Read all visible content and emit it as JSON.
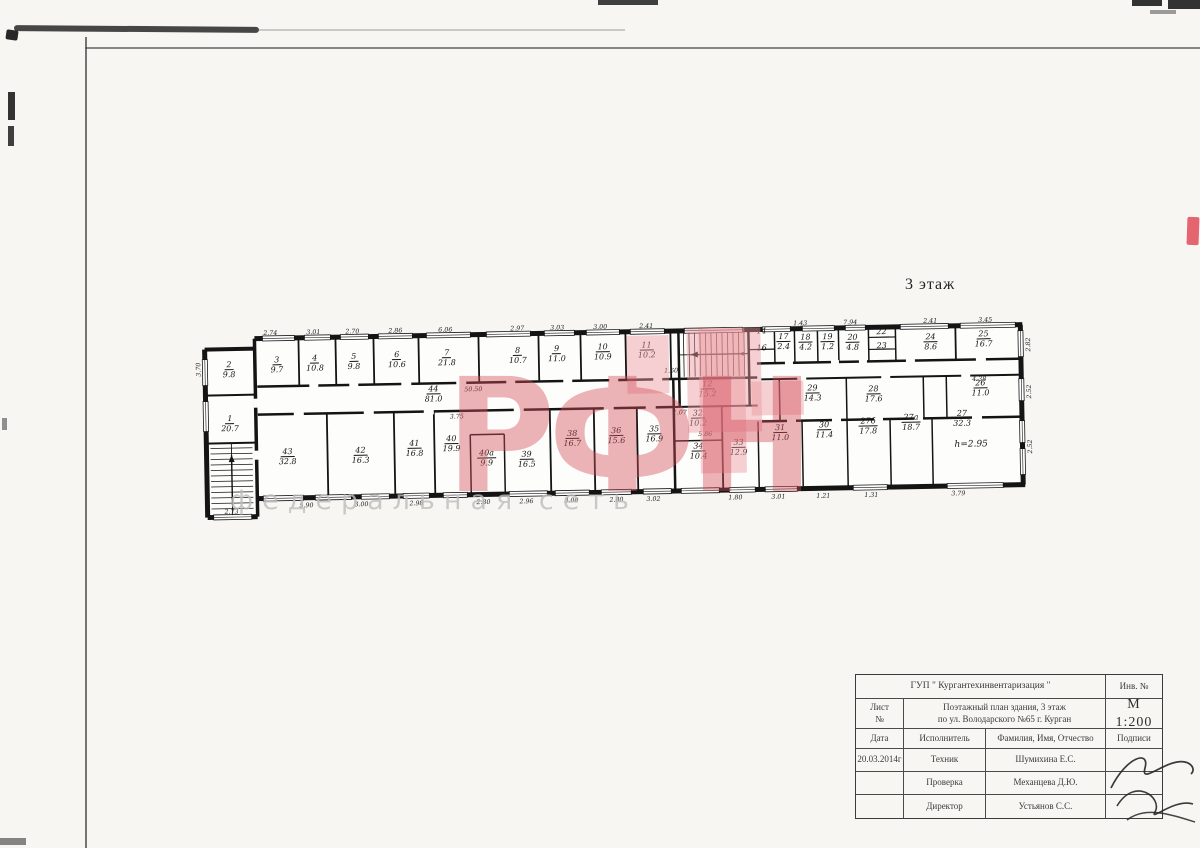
{
  "page": {
    "floor_label": "3 этаж",
    "watermark_big": "РФН",
    "watermark_sub": "федеральная сеть",
    "accent_pink": "#e0a6ab",
    "stamp_red": "#e04a58",
    "ink": "#141414"
  },
  "plan": {
    "h_label": "h=2.95",
    "rooms": [
      {
        "num": "1",
        "area": "20.7",
        "x": 28,
        "y": 92
      },
      {
        "num": "2",
        "area": "9.8",
        "x": 28,
        "y": 38
      },
      {
        "num": "3",
        "area": "9.7",
        "x": 76,
        "y": 34
      },
      {
        "num": "4",
        "area": "10.8",
        "x": 114,
        "y": 33
      },
      {
        "num": "5",
        "area": "9.8",
        "x": 153,
        "y": 32
      },
      {
        "num": "6",
        "area": "10.6",
        "x": 196,
        "y": 31
      },
      {
        "num": "7",
        "area": "21.8",
        "x": 246,
        "y": 30
      },
      {
        "num": "8",
        "area": "10.7",
        "x": 317,
        "y": 29
      },
      {
        "num": "9",
        "area": "11.0",
        "x": 356,
        "y": 28
      },
      {
        "num": "10",
        "area": "10.9",
        "x": 402,
        "y": 27
      },
      {
        "num": "11",
        "area": "10.2",
        "x": 446,
        "y": 26
      },
      {
        "num": "14",
        "area": "",
        "x": 561,
        "y": 14
      },
      {
        "num": "16",
        "area": "",
        "x": 561,
        "y": 31
      },
      {
        "num": "17",
        "area": "2.4",
        "x": 583,
        "y": 20
      },
      {
        "num": "18",
        "area": "4.2",
        "x": 605,
        "y": 21
      },
      {
        "num": "19",
        "area": "1.2",
        "x": 627,
        "y": 21
      },
      {
        "num": "20",
        "area": "4.8",
        "x": 652,
        "y": 22
      },
      {
        "num": "22",
        "area": "",
        "x": 681,
        "y": 17
      },
      {
        "num": "23",
        "area": "",
        "x": 681,
        "y": 31
      },
      {
        "num": "24",
        "area": "8.6",
        "x": 730,
        "y": 23
      },
      {
        "num": "25",
        "area": "16.7",
        "x": 783,
        "y": 21
      },
      {
        "num": "44",
        "area": "81.0",
        "x": 232,
        "y": 66
      },
      {
        "num": "12",
        "area": "15.2",
        "x": 506,
        "y": 66
      },
      {
        "num": "29",
        "area": "14.3",
        "x": 611,
        "y": 72
      },
      {
        "num": "28",
        "area": "17.6",
        "x": 672,
        "y": 74
      },
      {
        "num": "26",
        "area": "11.0",
        "x": 779,
        "y": 70
      },
      {
        "num": "32",
        "area": "10.2",
        "x": 496,
        "y": 95
      },
      {
        "num": "43",
        "area": "32.8",
        "x": 85,
        "y": 126
      },
      {
        "num": "42",
        "area": "16.3",
        "x": 158,
        "y": 126
      },
      {
        "num": "41",
        "area": "16.8",
        "x": 212,
        "y": 120
      },
      {
        "num": "40",
        "area": "19.9",
        "x": 249,
        "y": 116
      },
      {
        "num": "40а",
        "area": "9.9",
        "x": 284,
        "y": 131
      },
      {
        "num": "39",
        "area": "16.5",
        "x": 324,
        "y": 133
      },
      {
        "num": "38",
        "area": "16.7",
        "x": 370,
        "y": 113
      },
      {
        "num": "36",
        "area": "15.6",
        "x": 414,
        "y": 111
      },
      {
        "num": "35",
        "area": "16.9",
        "x": 452,
        "y": 110
      },
      {
        "num": "34",
        "area": "10.4",
        "x": 496,
        "y": 128
      },
      {
        "num": "33",
        "area": "12.9",
        "x": 536,
        "y": 125
      },
      {
        "num": "31",
        "area": "11.0",
        "x": 578,
        "y": 111
      },
      {
        "num": "30",
        "area": "11.4",
        "x": 622,
        "y": 109
      },
      {
        "num": "27б",
        "area": "17.8",
        "x": 666,
        "y": 106
      },
      {
        "num": "27а",
        "area": "18.7",
        "x": 709,
        "y": 103
      },
      {
        "num": "27",
        "area": "32.3",
        "x": 760,
        "y": 100
      }
    ],
    "dims": [
      {
        "t": "2.74",
        "x": 70,
        "y": 3
      },
      {
        "t": "3.01",
        "x": 113,
        "y": 3
      },
      {
        "t": "2.70",
        "x": 152,
        "y": 3
      },
      {
        "t": "2.86",
        "x": 195,
        "y": 3
      },
      {
        "t": "6.06",
        "x": 245,
        "y": 3
      },
      {
        "t": "2.97",
        "x": 317,
        "y": 3
      },
      {
        "t": "3.03",
        "x": 357,
        "y": 3
      },
      {
        "t": "3.00",
        "x": 400,
        "y": 3
      },
      {
        "t": "2.41",
        "x": 446,
        "y": 3
      },
      {
        "t": "1.43",
        "x": 600,
        "y": 3
      },
      {
        "t": "7.94",
        "x": 650,
        "y": 3
      },
      {
        "t": "2.41",
        "x": 730,
        "y": 3
      },
      {
        "t": "3.45",
        "x": 785,
        "y": 3
      },
      {
        "t": "2.73",
        "x": 28,
        "y": 181
      },
      {
        "t": "5.90",
        "x": 103,
        "y": 176
      },
      {
        "t": "3.00",
        "x": 158,
        "y": 176
      },
      {
        "t": "2.98",
        "x": 213,
        "y": 176
      },
      {
        "t": "2.80",
        "x": 280,
        "y": 176
      },
      {
        "t": "2.96",
        "x": 323,
        "y": 176
      },
      {
        "t": "3.00",
        "x": 368,
        "y": 176
      },
      {
        "t": "2.80",
        "x": 413,
        "y": 176
      },
      {
        "t": "3.02",
        "x": 450,
        "y": 176
      },
      {
        "t": "1.80",
        "x": 532,
        "y": 176
      },
      {
        "t": "3.01",
        "x": 575,
        "y": 176
      },
      {
        "t": "1.21",
        "x": 620,
        "y": 176
      },
      {
        "t": "1.31",
        "x": 668,
        "y": 176
      },
      {
        "t": "3.79",
        "x": 755,
        "y": 176
      },
      {
        "t": "3.70",
        "x": -2,
        "y": 38,
        "r": 1
      },
      {
        "t": "2.82",
        "x": 828,
        "y": 28,
        "r": 1
      },
      {
        "t": "2.52",
        "x": 828,
        "y": 75,
        "r": 1
      },
      {
        "t": "2.52",
        "x": 828,
        "y": 130,
        "r": 1
      },
      {
        "t": "50.50",
        "x": 272,
        "y": 63
      },
      {
        "t": "3.75",
        "x": 255,
        "y": 90
      },
      {
        "t": "5.86",
        "x": 503,
        "y": 112
      },
      {
        "t": "4.38",
        "x": 778,
        "y": 62
      },
      {
        "t": "1.07",
        "x": 478,
        "y": 90
      },
      {
        "t": "1.60",
        "x": 470,
        "y": 48
      }
    ]
  },
  "title_block": {
    "org": "ГУП \" Кургантехинвентаризация \"",
    "inv_label": "Инв. №",
    "sheet_label": "Лист\n№",
    "doc_line1": "Поэтажный план здания, 3 этаж",
    "doc_line2": "по ул. Володарского №65 г. Курган",
    "scale": "М 1:200",
    "col_date": "Дата",
    "col_role": "Исполнитель",
    "col_name": "Фамилия, Имя, Отчество",
    "col_sign": "Подписи",
    "rows": [
      {
        "date": "20.03.2014г",
        "role": "Техник",
        "name": "Шумихина Е.С."
      },
      {
        "date": "",
        "role": "Проверка",
        "name": "Механцева Д.Ю."
      },
      {
        "date": "",
        "role": "Директор",
        "name": "Устьянов С.С."
      }
    ]
  }
}
